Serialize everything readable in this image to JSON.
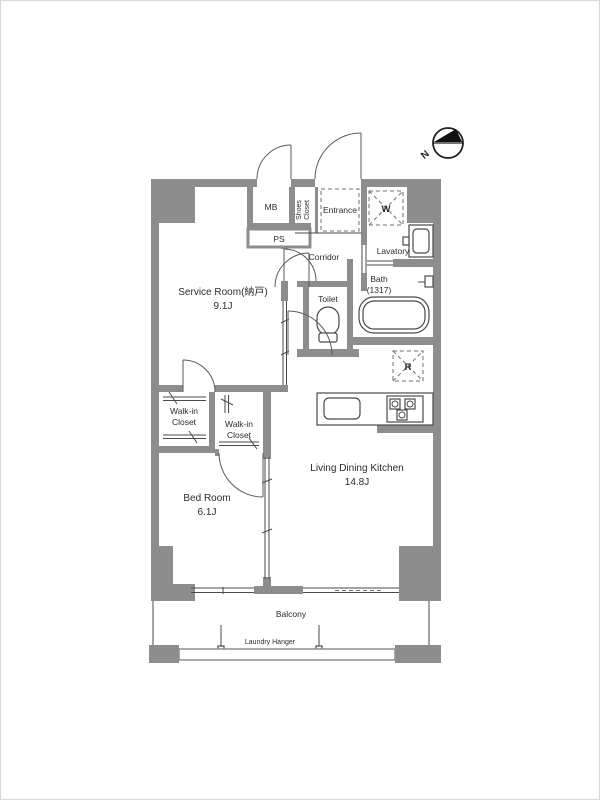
{
  "fp": {
    "compass": {
      "north": "N"
    },
    "labels": {
      "mb": "MB",
      "ps": "PS",
      "shoes1": "Shoes",
      "shoes2": "Closet",
      "entrance": "Entrance",
      "washer": "W",
      "lavatory": "Lavatory",
      "bath1": "Bath",
      "bath2": "(1317)",
      "corridor": "Corridor",
      "toilet": "Toilet",
      "service1": "Service Room(納戸)",
      "service2": "9.1J",
      "wic1a": "Walk-in",
      "wic1b": "Closet",
      "wic2a": "Walk-in",
      "wic2b": "Closet",
      "bedroom1": "Bed Room",
      "bedroom2": "6.1J",
      "ldk1": "Living Dining Kitchen",
      "ldk2": "14.8J",
      "fridge": "R",
      "balcony": "Balcony",
      "laundry": "Laundry Hanger"
    },
    "colors": {
      "wall": "#8d8d8d",
      "line": "#4a4a4a",
      "background": "#ffffff"
    }
  }
}
